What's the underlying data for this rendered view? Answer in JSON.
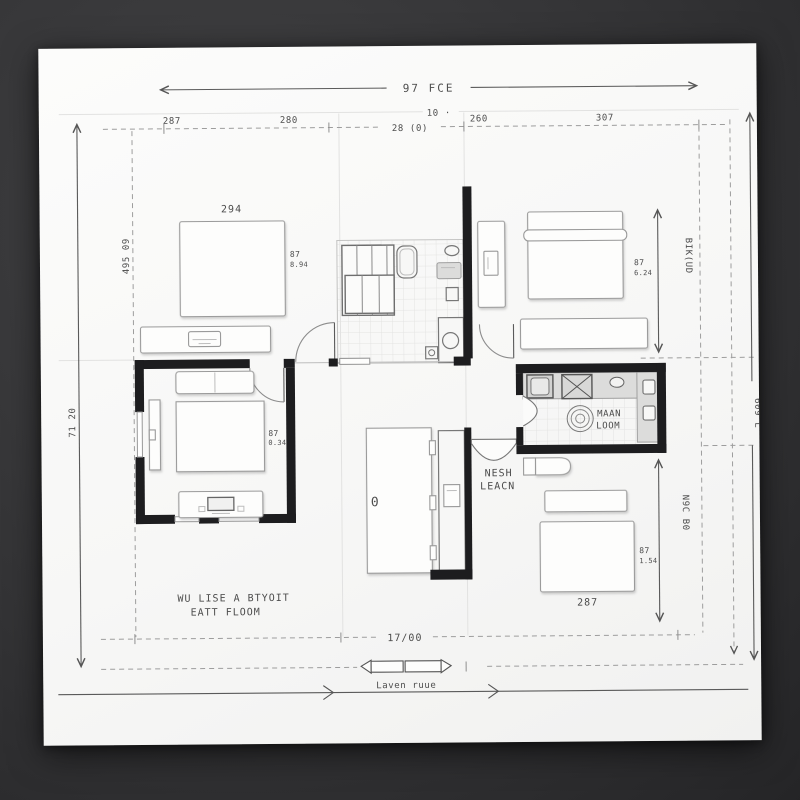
{
  "dims": {
    "overall_width": "97 FCE",
    "small_offset": "10 ·",
    "top_row": [
      "287",
      "280",
      "28 (0)",
      "260",
      "307"
    ],
    "left_outer": "71 20",
    "left_inner": "495 09",
    "right_inner_top": "BIK(UD",
    "right_outer": "609 L",
    "right_inner_bottom": "N9C B0",
    "bottom_width": "17/00",
    "bed_tl": "294",
    "bed_tl_side": "87",
    "bed_tl_side2": "8.94",
    "tr_side": "87",
    "tr_side2": "6.24",
    "living_side": "87",
    "living_side2": "0.34",
    "br_bed": "287",
    "br_side": "87",
    "br_side2": "1.54"
  },
  "labels": {
    "kitchen1": "MAAN",
    "kitchen2": "LOOM",
    "hall1": "NESH",
    "hall2": "LEACN",
    "note1": "WU LISE A BTYOIT",
    "note2": "EATT FLOOM",
    "scale": "Laven ruue",
    "table_mark": "0"
  },
  "colors": {
    "paper": "#faf9f8",
    "wall": "#1d1d1f",
    "dimension_line": "#9d9d9d",
    "text": "#4d4d4d"
  }
}
